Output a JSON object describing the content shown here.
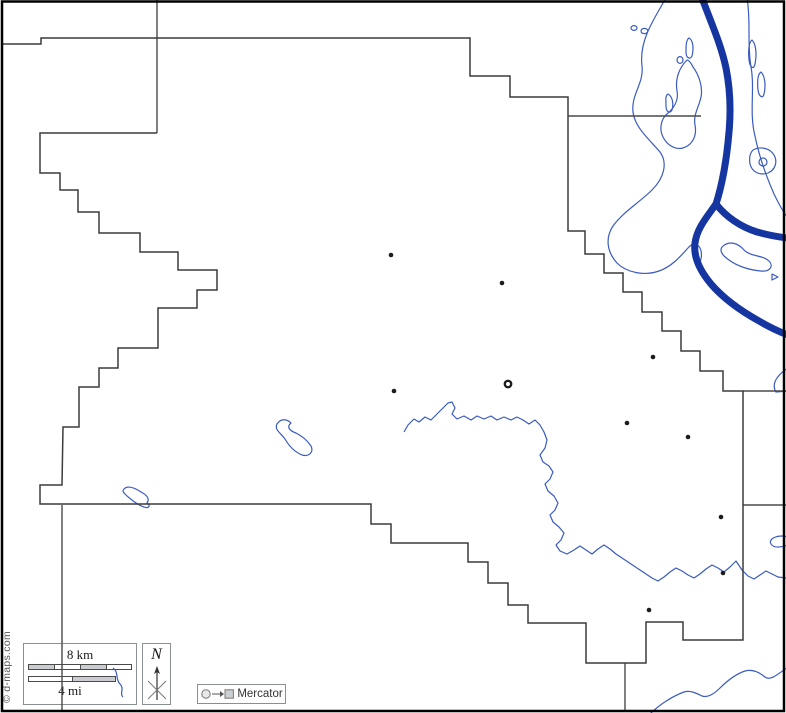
{
  "credit": "© d-maps.com",
  "scale_box": {
    "km_label": "8 km",
    "mi_label": "4 mi",
    "km_segments": [
      {
        "w": 26,
        "fill": "#c9cdd1"
      },
      {
        "w": 26,
        "fill": "#ffffff"
      },
      {
        "w": 26,
        "fill": "#c9cdd1"
      },
      {
        "w": 26,
        "fill": "#ffffff"
      }
    ],
    "mi_segments": [
      {
        "w": 44,
        "fill": "#ffffff"
      },
      {
        "w": 44,
        "fill": "#c9cdd1"
      }
    ]
  },
  "north_box": {
    "label": "N"
  },
  "legend": {
    "label": "Mercator"
  },
  "colors": {
    "boundary": "#3c3c3c",
    "river": "#1535a0",
    "stream": "#3a5bc0",
    "town_dot": "#1c1c1c",
    "scale_gray": "#c9cdd1",
    "box_border": "#8a8f94",
    "frame": "#000000",
    "background": "#ffffff"
  },
  "map": {
    "frame_d": "M 2,1.5 L 784,1.5 L 784,711 L 2,711 Z",
    "county_outline_d": "M 3,44 L 41,44 L 41,38 L 470,38 L 470,76 L 510,76 L 510,97 L 568,97 L 568,231 L 585,231 L 585,254 L 604,254 L 604,273 L 623,273 L 623,292 L 642,292 L 642,312 L 662,312 L 662,331 L 681,331 L 681,351 L 700,351 L 700,371 L 723,371 L 723,391 L 743,391 L 743,640 L 683,640 L 683,622 L 646,622 L 646,663 L 586,663 L 586,623 L 528,623 L 528,605 L 508,605 L 508,583 L 488,583 L 488,562 L 468,562 L 468,543 L 391,543 L 391,524 L 371,524 L 371,504 L 40,504 L 40,485 L 62,485 L 63,427 L 79,427 L 79,387 L 99,387 L 99,368 L 118,368 L 118,348 L 158,348 L 158,308 L 197,308 L 197,290 L 217,290 L 217,270 L 178,270 L 178,252 L 140,252 L 140,233 L 99,233 L 99,212 L 78,212 L 78,190 L 60,190 L 60,173 L 40,173 L 40,133 L 157,133",
    "neighbor_segments": [
      {
        "name": "north-edge-line",
        "d": "M 157,0 L 157,133"
      },
      {
        "name": "east-edge-line-upper",
        "d": "M 568,116 L 701,116"
      },
      {
        "name": "east-edge-line-mid",
        "d": "M 743,391 L 786,391"
      },
      {
        "name": "east-edge-line-lower",
        "d": "M 743,505 L 786,505"
      },
      {
        "name": "south-edge-line-west",
        "d": "M 62,505 L 62,710"
      },
      {
        "name": "south-edge-line-east",
        "d": "M 625,663 L 625,710"
      }
    ],
    "rivers": [
      {
        "name": "main-river",
        "d": "M 702,-2 C 710,20 721,44 726,68 C 730,88 731,110 729,132 C 727,156 723,182 716,204"
      },
      {
        "name": "river-branch-east",
        "d": "M 716,204 C 726,217 741,227 757,232 C 768,235 778,237 788,238"
      },
      {
        "name": "river-branch-south",
        "d": "M 716,204 C 707,217 697,228 695,243 C 693,258 701,272 711,284 C 723,298 741,311 759,321 C 771,328 780,332 788,335"
      }
    ],
    "streams": [
      {
        "name": "floodplain-west-lobe",
        "d": "M 666,-2 C 652,22 639,42 642,66 C 644,84 631,94 633,112 C 635,128 650,140 660,152 C 668,163 664,178 652,190 C 640,202 623,212 613,226 C 605,238 607,252 617,263 C 627,273 645,276 659,271 C 671,267 680,257 688,248 C 692,243 697,243 700,248 C 703,254 701,262 697,268"
      },
      {
        "name": "floodplain-inner-blob",
        "d": "M 687,60 C 679,68 675,79 677,91 C 679,101 673,109 667,114 C 661,119 659,129 663,137 C 667,145 675,150 683,148 C 693,145 697,135 695,125 C 693,115 699,107 701,97 C 703,87 699,75 693,67 C 691,63 689,60 687,60 Z"
      },
      {
        "name": "islet-a",
        "d": "M 631,28 a 3,2.4 0 1 0 6,0 a 3,2.4 0 1 0 -6,0 Z"
      },
      {
        "name": "islet-b",
        "d": "M 641,31 a 3.4,2.6 0 1 0 6.8,0 a 3.4,2.6 0 1 0 -6.8,0 Z"
      },
      {
        "name": "islet-c",
        "d": "M 677,60 a 3,3.4 0 1 0 6,0 a 3,3.4 0 1 0 -6,0 Z"
      },
      {
        "name": "islet-d",
        "d": "M 689,38 C 693,40 694,48 692,56 C 690,60 686,58 686,52 C 686,46 686,40 689,38 Z"
      },
      {
        "name": "islet-e",
        "d": "M 668,94 C 672,96 674,103 672,110 C 670,114 666,112 666,106 C 666,100 665,96 668,94 Z"
      },
      {
        "name": "floodplain-east-outline",
        "d": "M 747,-2 C 751,20 747,44 751,67 C 755,89 749,113 755,136 C 759,156 767,178 774,194 C 779,204 783,212 788,218"
      },
      {
        "name": "islet-f",
        "d": "M 752,40 C 756,44 757,54 755,64 C 754,70 750,68 749,60 C 748,50 749,42 752,40 Z"
      },
      {
        "name": "islet-g",
        "d": "M 761,72 C 765,76 766,86 764,94 C 763,99 759,97 758,90 C 757,80 758,74 761,72 Z"
      },
      {
        "name": "oxbow-blob",
        "d": "M 753,150 C 760,146 770,148 774,155 C 778,162 775,170 768,173 C 760,176 752,172 750,164 C 749,158 750,153 753,150 Z"
      },
      {
        "name": "oxbow-ring",
        "d": "M 759,162 a 4,4 0 1 0 8,0 a 4,4 0 1 0 -8,0 Z"
      },
      {
        "name": "fish-blob",
        "d": "M 722,247 C 729,240 738,243 744,250 C 751,257 763,255 769,261 C 774,266 770,272 761,271 C 749,270 737,266 729,260 C 723,256 719,251 722,247 Z"
      },
      {
        "name": "fish-fin",
        "d": "M 772,274 l 6,3 l -6,3 Z"
      },
      {
        "name": "right-edge-curl",
        "d": "M 788,368 C 777,375 771,384 776,392 L 788,391"
      },
      {
        "name": "central-creek",
        "d": "M 404,432 L 408,425 L 414,419 L 419,422 L 425,417 L 431,420 L 437,414 L 443,408 L 448,403 L 452,402 L 455,408 L 452,414 L 457,419 L 464,416 L 471,420 L 477,416 L 484,419 L 491,416 L 497,420 L 504,417 L 511,420 L 517,417 L 523,420 L 529,424 L 535,420 L 540,425 L 544,432 L 547,440 L 545,448 L 540,455 L 543,462 L 549,466 L 553,472 L 550,479 L 545,484 L 548,491 L 554,496 L 558,503 L 555,510 L 550,515 L 553,522 L 559,527 L 564,533 L 561,540 L 556,545 L 560,551 L 567,554 L 574,550 L 580,546 L 586,550 L 592,554 L 598,549 L 604,545 L 610,549 L 616,554 L 622,558 L 628,562 L 634,566 L 640,570 L 646,574 L 652,578 L 658,581 L 664,577 L 670,572 L 676,568 L 682,571 L 688,575 L 694,578 L 700,574 L 706,569 L 712,565 L 718,568 L 724,572 L 730,567 L 736,561 L 742,570 L 748,576 L 754,579 L 760,575 L 766,571 L 772,574 L 778,577 L 786,578"
      },
      {
        "name": "center-lake",
        "d": "M 277,424 C 281,418 287,419 291,423 C 286,427 290,431 296,433 C 302,436 307,440 311,446 C 314,452 309,457 302,455 C 295,452 289,446 285,439 C 281,433 274,430 277,424 Z"
      },
      {
        "name": "southwest-pond",
        "d": "M 124,489 C 128,485 135,488 141,492 C 147,495 150,499 147,503 C 151,505 149,509 144,507 C 138,505 130,499 126,495 C 123,492 122,491 124,489 Z"
      },
      {
        "name": "scalebox-brook",
        "d": "M 113,668 C 119,672 115,679 120,684 C 125,689 119,693 123,697"
      },
      {
        "name": "right-edge-hook",
        "d": "M 788,537 C 777,534 768,539 771,544 C 774,549 782,547 788,545"
      },
      {
        "name": "bottomright-creek",
        "d": "M 650,714 C 660,704 673,696 684,692 C 690,690 696,693 702,696 C 708,698 714,694 720,688 C 727,681 736,674 745,671 C 752,669 759,672 765,677 C 770,681 777,675 788,667"
      }
    ],
    "towns": [
      {
        "x": 391,
        "y": 255
      },
      {
        "x": 502,
        "y": 283
      },
      {
        "x": 653,
        "y": 357
      },
      {
        "x": 394,
        "y": 391
      },
      {
        "x": 627,
        "y": 423
      },
      {
        "x": 688,
        "y": 437
      },
      {
        "x": 721,
        "y": 517
      },
      {
        "x": 723,
        "y": 573
      },
      {
        "x": 649,
        "y": 610
      }
    ],
    "county_seat": {
      "x": 508,
      "y": 384,
      "r": 3.2
    }
  }
}
